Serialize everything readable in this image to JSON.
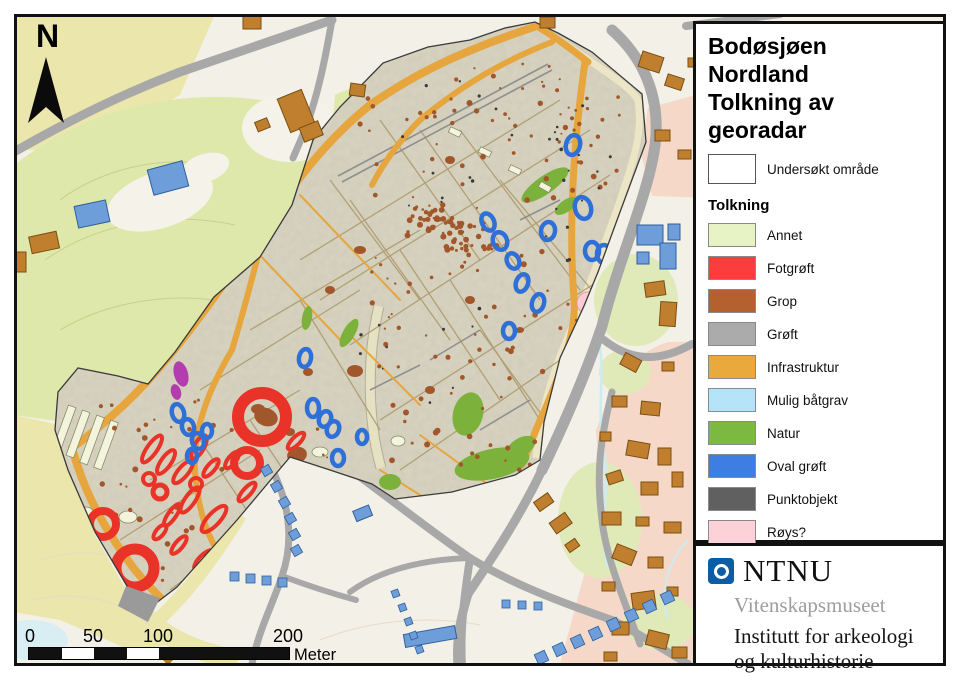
{
  "map_title": {
    "line1": "Bodøsjøen",
    "line2": "Nordland",
    "line3": "Tolkning av georadar"
  },
  "legend": {
    "surveyed_label": "Undersøkt område",
    "surveyed_color": "#ffffff",
    "section_heading": "Tolkning",
    "items": [
      {
        "label": "Annet",
        "color": "#e7f2c5"
      },
      {
        "label": "Fotgrøft",
        "color": "#fb3d3d"
      },
      {
        "label": "Grop",
        "color": "#b4602f"
      },
      {
        "label": "Grøft",
        "color": "#ababab"
      },
      {
        "label": "Infrastruktur",
        "color": "#e9a93c"
      },
      {
        "label": "Mulig båtgrav",
        "color": "#b5e3f7"
      },
      {
        "label": "Natur",
        "color": "#7cb940"
      },
      {
        "label": "Oval grøft",
        "color": "#3e7ee2"
      },
      {
        "label": "Punktobjekt",
        "color": "#606060"
      },
      {
        "label": "Røys?",
        "color": "#fcd2d8"
      },
      {
        "label": "Sykehus?",
        "color": "#bb40b4"
      }
    ]
  },
  "north_label": "N",
  "scalebar": {
    "labels": [
      "0",
      "50",
      "100",
      "200"
    ],
    "unit": "Meter"
  },
  "credits": {
    "org": "NTNU",
    "museum": "Vitenskapsmuseet",
    "dept_line1": "Institutt for arkeologi",
    "dept_line2": "og kulturhistorie"
  }
}
